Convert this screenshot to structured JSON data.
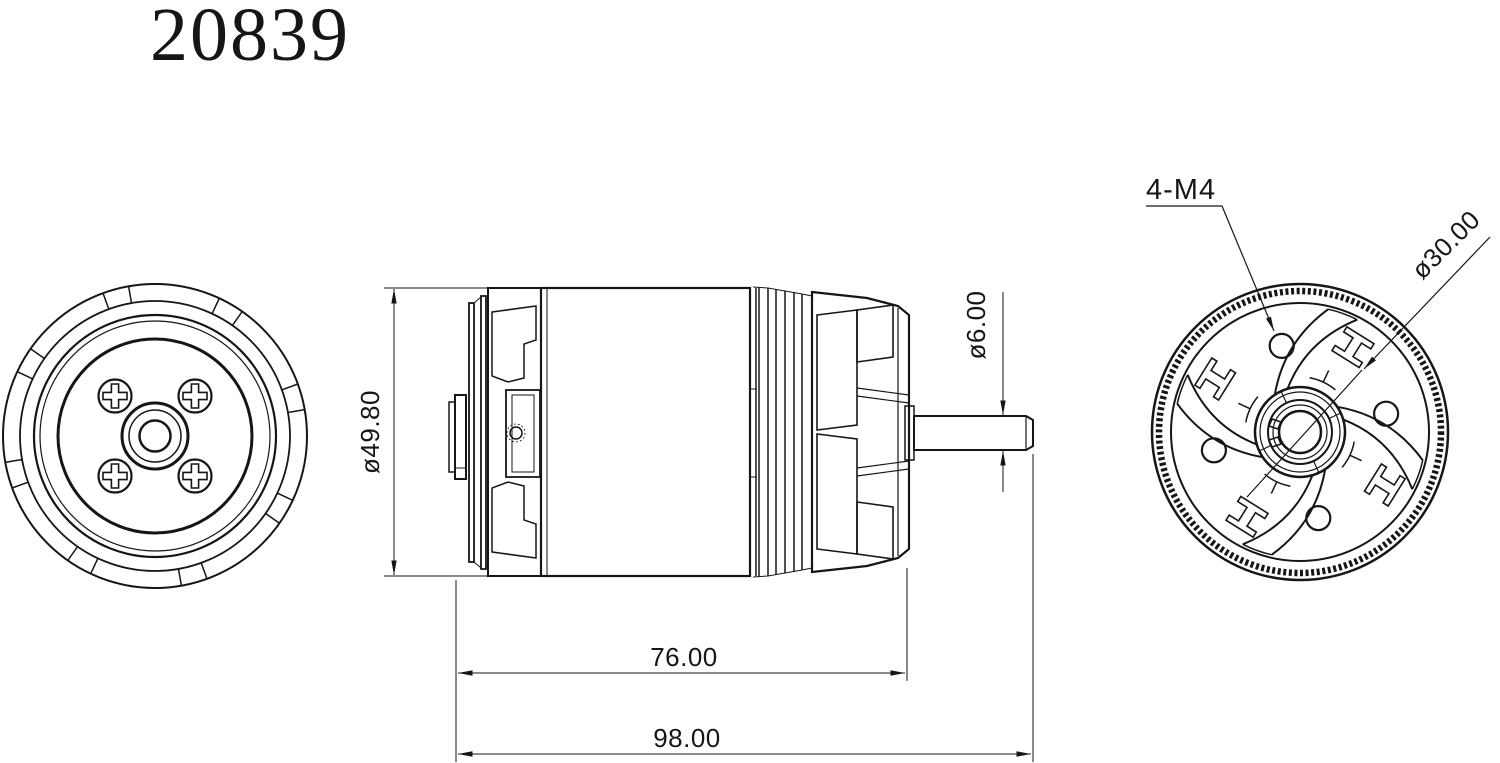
{
  "title": "20839",
  "dimensions": {
    "body_diameter": "ø49.80",
    "body_length": "76.00",
    "overall_length": "98.00",
    "shaft_diameter": "ø6.00",
    "mounting_holes": "4-M4",
    "bolt_circle_diameter": "ø30.00"
  },
  "colors": {
    "line": "#161616",
    "background": "#ffffff"
  }
}
